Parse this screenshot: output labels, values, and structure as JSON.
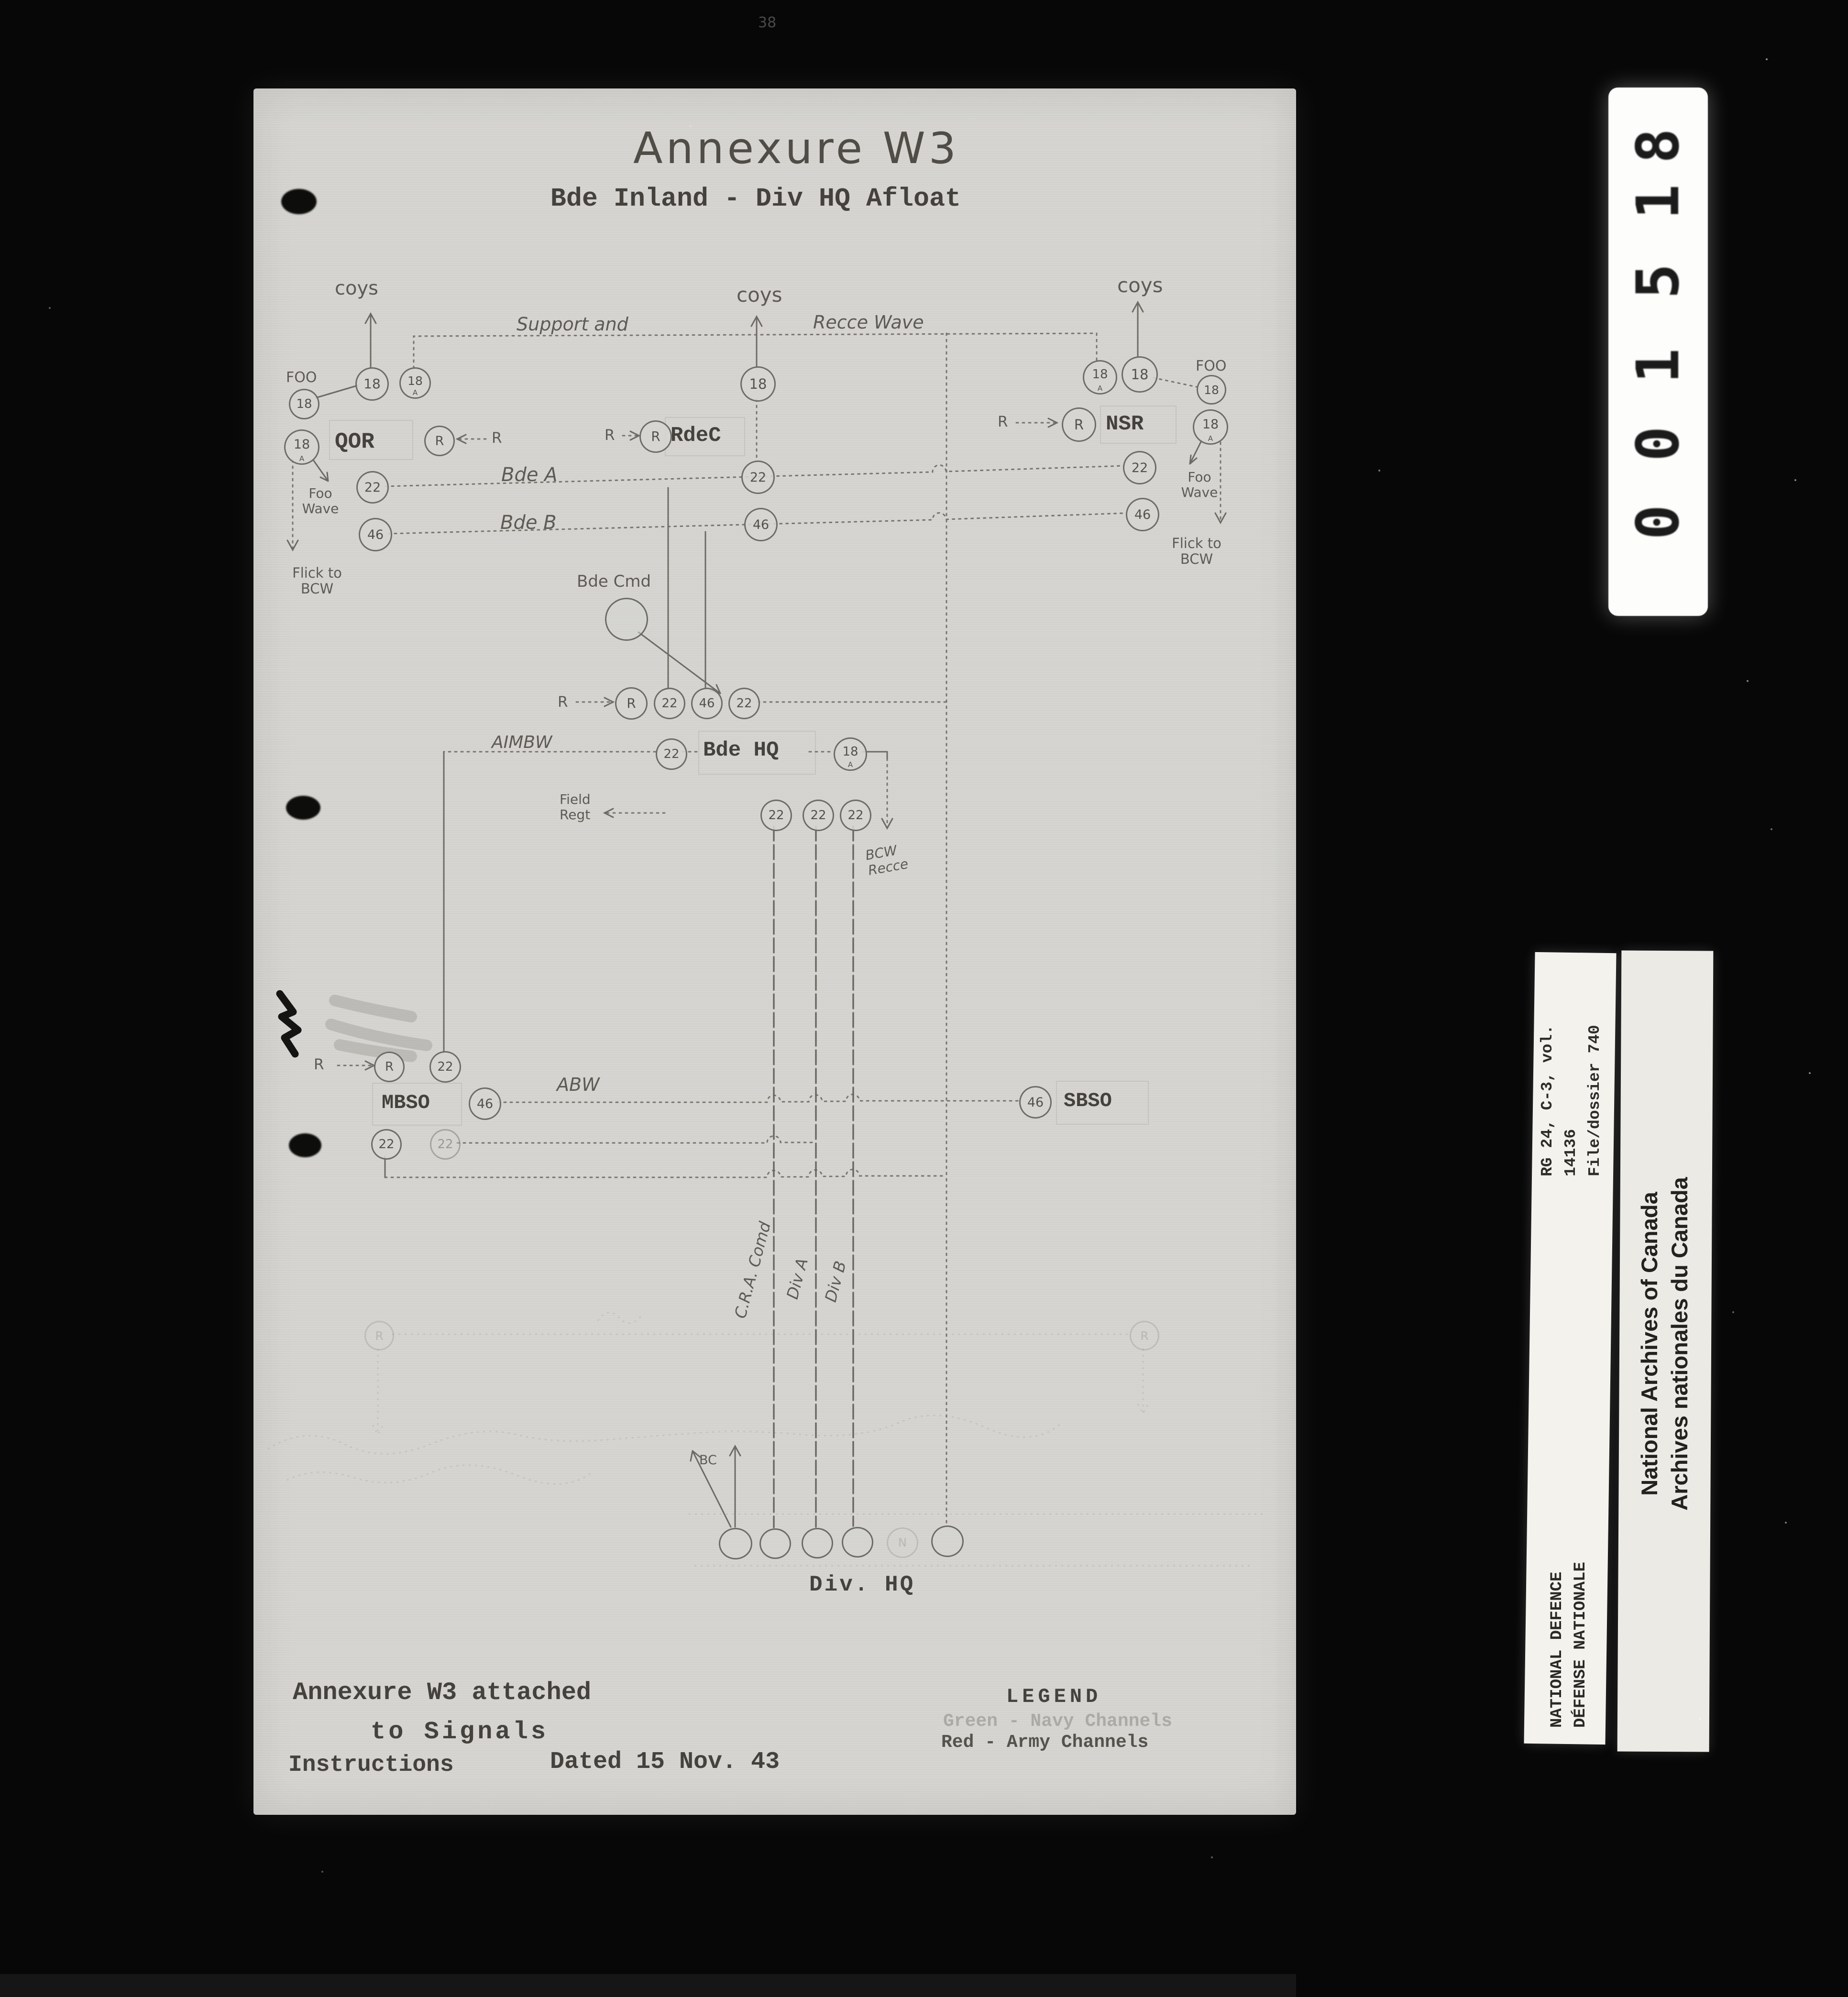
{
  "header": {
    "title": "Annexure W3",
    "subtitle": "Bde Inland - Div HQ Afloat",
    "corner_mark": "38"
  },
  "labels": {
    "coys": "coys",
    "support_and": "Support and",
    "recce_wave": "Recce Wave",
    "foo": "FOO",
    "foo_wave_l1": "Foo",
    "foo_wave_l2": "Wave",
    "flick_l1": "Flick to",
    "flick_l2": "BCW",
    "qor": "QOR",
    "rdec": "RdeC",
    "nsr": "NSR",
    "r": "R",
    "bde_a": "Bde A",
    "bde_b": "Bde B",
    "bde_cmd": "Bde Cmd",
    "aimbw": "AIMBW",
    "bde_hq": "Bde HQ",
    "field_l1": "Field",
    "field_l2": "Regt",
    "bcw_l1": "BCW",
    "bcw_l2": "Recce",
    "mbso": "MBSO",
    "abw": "ABW",
    "sbso": "SBSO",
    "cra_comd": "C.R.A. Comd",
    "div_a": "Div A",
    "div_b": "Div B",
    "bc": "BC",
    "div_hq": "Div. HQ"
  },
  "circles": {
    "c18": "18",
    "c22": "22",
    "c46": "46",
    "cR": "R",
    "cN": "N",
    "subA": "A"
  },
  "footer": {
    "line1": "Annexure W3 attached",
    "line2": "to Signals",
    "line3": "Instructions",
    "line4": "Dated 15 Nov. 43"
  },
  "legend": {
    "heading": "LEGEND",
    "navy": "Green - Navy Channels",
    "army": "Red  - Army Channels"
  },
  "microfilm": {
    "digits": [
      "8",
      "1",
      "5",
      "1",
      "0",
      "0"
    ]
  },
  "archive": {
    "rg_line1": "RG 24, C-3, vol. 14136",
    "rg_line2": "File/dossier 740",
    "nd_line1": "NATIONAL DEFENCE",
    "nd_line2": "DÉFENSE NATIONALE",
    "na_line1": "National Archives of Canada",
    "na_line2": "Archives nationales du Canada"
  }
}
